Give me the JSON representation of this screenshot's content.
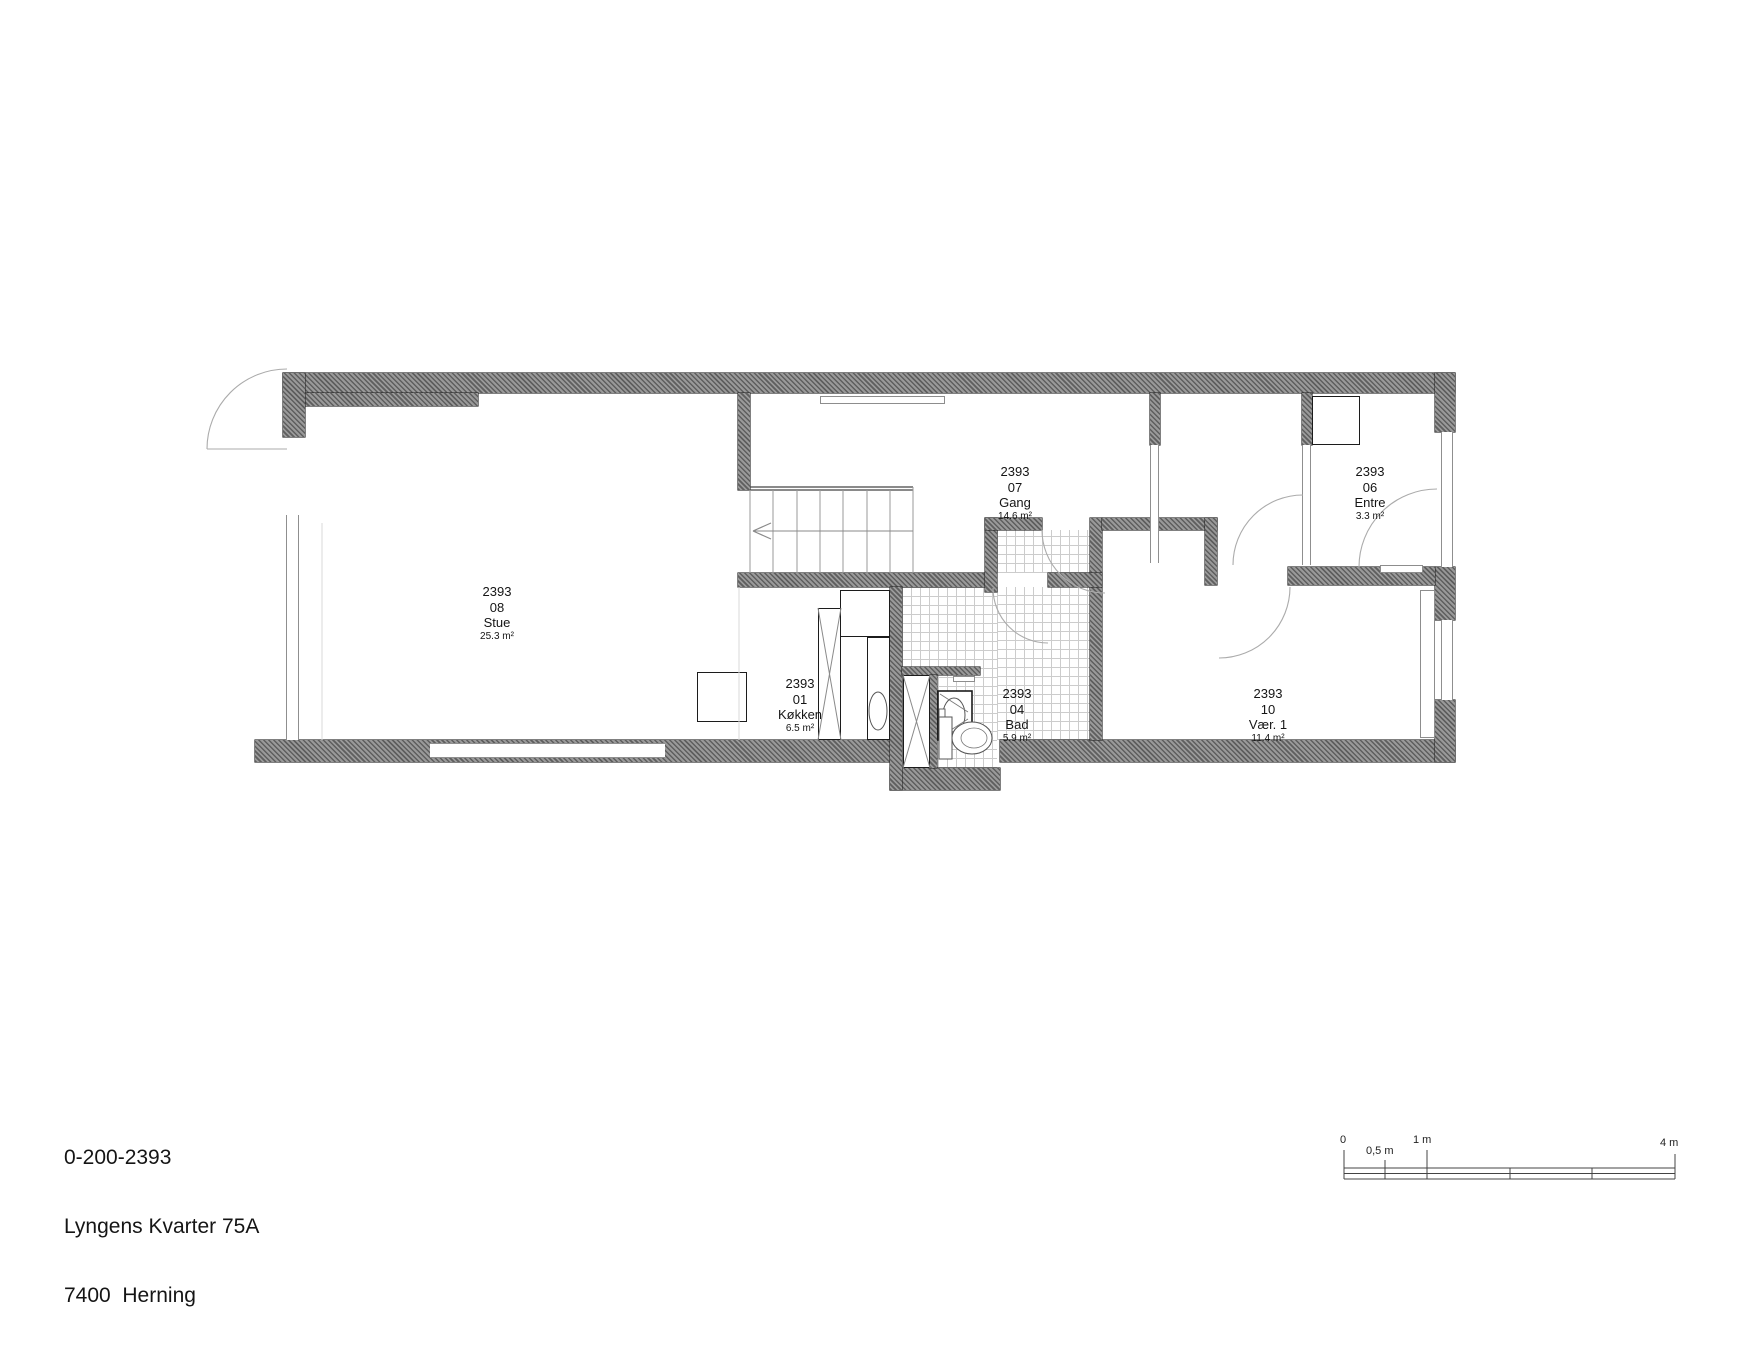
{
  "title_block": {
    "drawing_number": "0-200-2393",
    "address": "Lyngens Kvarter 75A",
    "city": "7400  Herning"
  },
  "rooms": [
    {
      "id": "2393",
      "number": "08",
      "name": "Stue",
      "area": "25.3 m²"
    },
    {
      "id": "2393",
      "number": "01",
      "name": "Køkken",
      "area": "6.5 m²"
    },
    {
      "id": "2393",
      "number": "04",
      "name": "Bad",
      "area": "5.9 m²"
    },
    {
      "id": "2393",
      "number": "07",
      "name": "Gang",
      "area": "14.6 m²"
    },
    {
      "id": "2393",
      "number": "06",
      "name": "Entre",
      "area": "3.3 m²"
    },
    {
      "id": "2393",
      "number": "10",
      "name": "Vær. 1",
      "area": "11.4 m²"
    }
  ],
  "scale_bar": {
    "zero": "0",
    "half": "0,5 m",
    "one": "1 m",
    "four": "4 m"
  },
  "colors": {
    "wall": "#6e6e6e",
    "outline": "#2b2b2b",
    "tile_line": "#cccccc",
    "door_arc": "#a9a9a9"
  }
}
